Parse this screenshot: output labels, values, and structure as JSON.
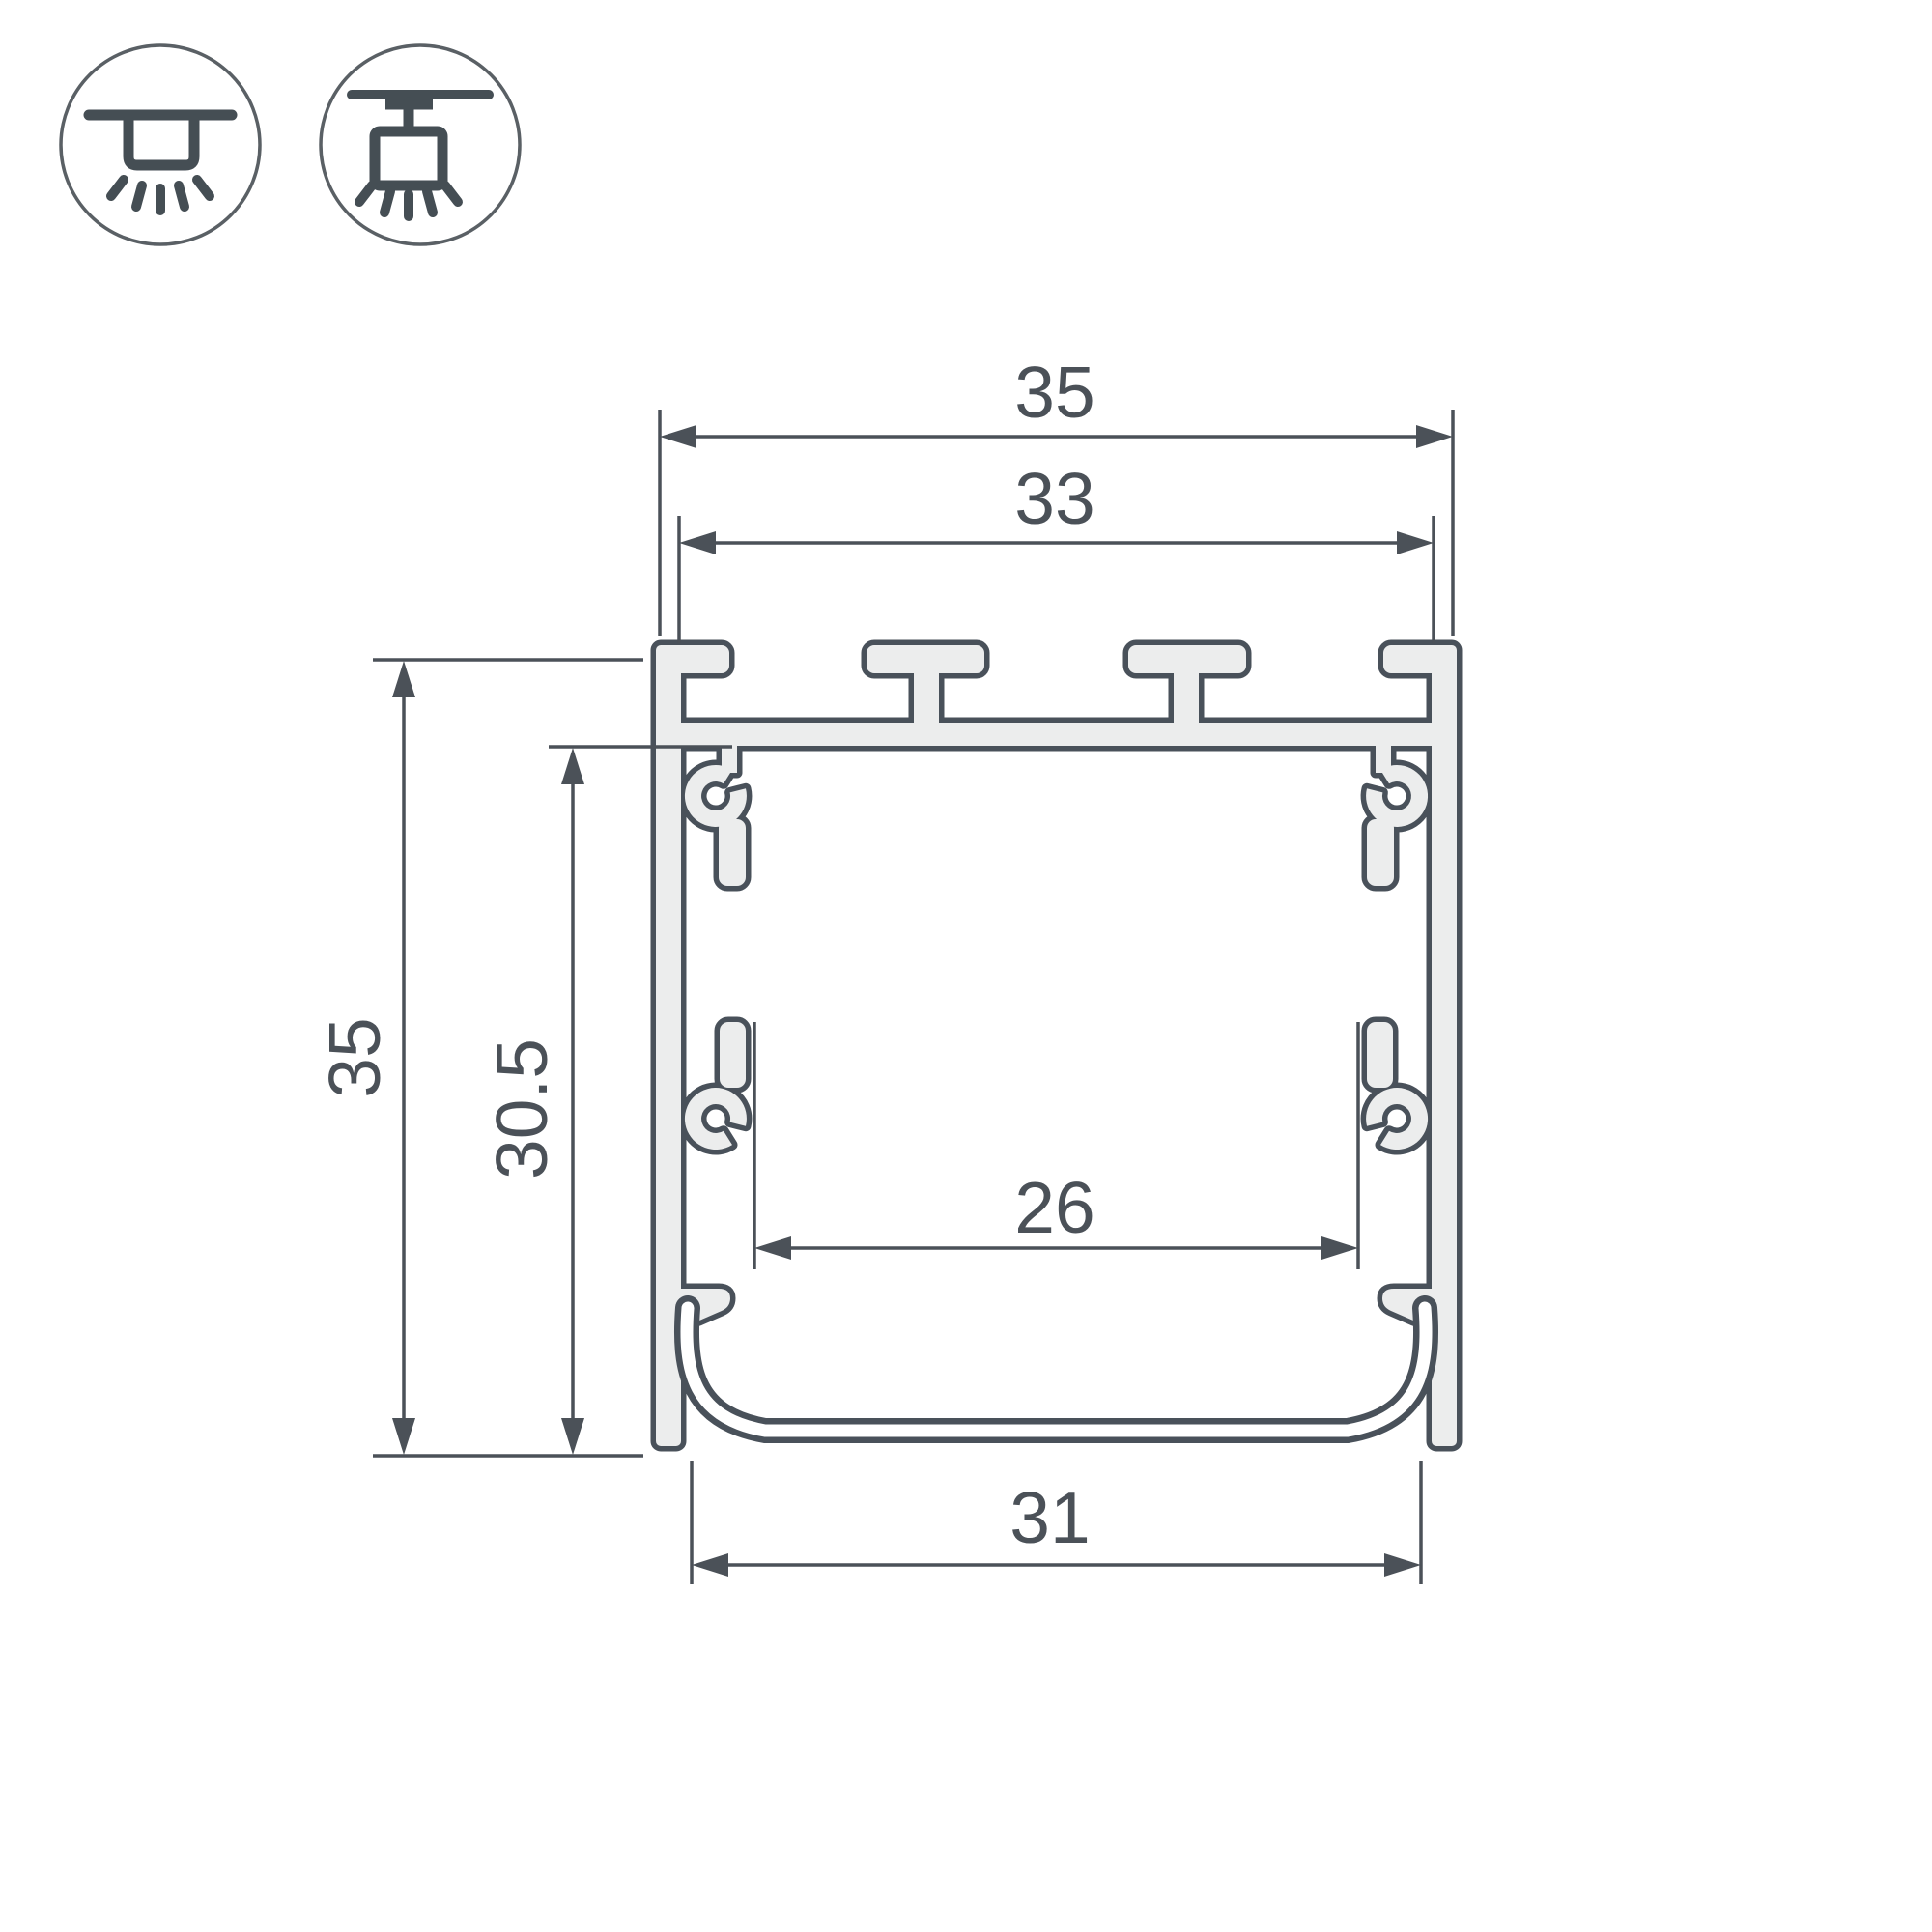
{
  "title": "LED aluminium profile cross-section dimensional drawing",
  "colors": {
    "background": "#ffffff",
    "outline": "#49515a",
    "metal_fill": "#eceded",
    "dimension_lines": "#4b5158",
    "icon_stroke": "#454e54"
  },
  "mount_icons": [
    {
      "name": "recessed-ceiling-light-icon"
    },
    {
      "name": "pendant-ceiling-light-icon"
    }
  ],
  "dimensions": {
    "overall_width": "35",
    "groove_span_width": "33",
    "overall_height": "35",
    "inner_height": "30.5",
    "inner_width": "26",
    "bottom_width": "31"
  }
}
